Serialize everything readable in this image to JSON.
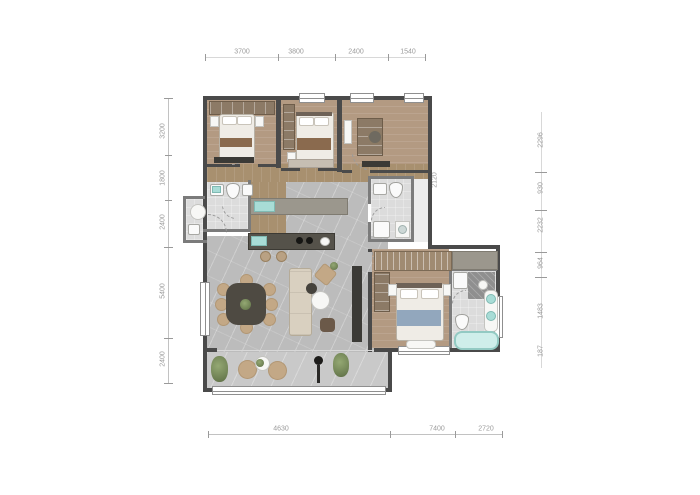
{
  "title": "apartment-floor-plan",
  "dimensions": {
    "top": [
      "3700",
      "3800",
      "2400",
      "1540"
    ],
    "left": [
      "3200",
      "1800",
      "2400",
      "5400",
      "2400"
    ],
    "bottom": [
      "4630",
      "7400",
      "2720"
    ],
    "right": [
      "2296",
      "930",
      "2232",
      "964",
      "1483",
      "187"
    ],
    "right_inner": [
      "2120"
    ]
  },
  "colors": {
    "wall": "#4a4a4a",
    "wood_floor": "#b39a82",
    "tile_floor": "#bcbcbc",
    "balcony_floor": "#c9c9c9",
    "bath_floor": "#dcdcdc",
    "fixture_teal": "#a8dcd6",
    "plant_green": "#6d7f52",
    "counter_dark": "#55524a",
    "accent_blue": "#92a7bd",
    "dim_text": "#9b9b9b"
  }
}
